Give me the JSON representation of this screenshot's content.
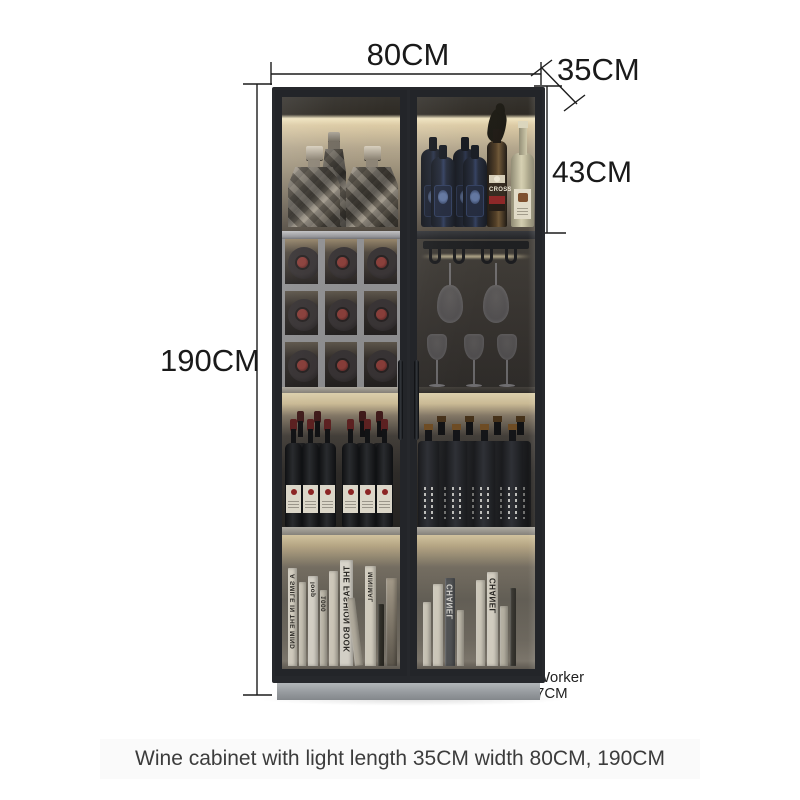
{
  "page": {
    "background": "#ffffff",
    "caption": "Wine cabinet with light length 35CM width 80CM, 190CM",
    "caption_color": "#3c3c3c",
    "caption_band_color": "#fafafa"
  },
  "dimensions": {
    "width": "80CM",
    "depth": "35CM",
    "top_section_height": "43CM",
    "height": "190CM",
    "base_note": "Worker",
    "base_height": "7CM",
    "line_color": "#1c1c1c"
  },
  "cabinet": {
    "frame_color": "#26282c",
    "base_color": "#a9adb0",
    "light_color": "#efe2bd",
    "accent_red": "#8c2424",
    "doors": 2,
    "top_shelf": {
      "decanters": 3,
      "blue_bottles": 4,
      "labeled_bottle": "CROSS",
      "white_wine_bottles": 1
    },
    "wine_rack": {
      "rows": 3,
      "columns": 3,
      "bottles": 9
    },
    "glass_rack": {
      "hanging_glasses": 2,
      "standing_glasses": 3
    },
    "bottle_rows": {
      "left_wine_bottles": 10,
      "right_square_bottles": 8
    },
    "book_labels_left": [
      "A SMILE IN THE MIND",
      "loop",
      "1000",
      "THE FASHION BOOK",
      "MINIMAL"
    ],
    "book_labels_right": [
      "CHANEL",
      "CHANEL"
    ]
  }
}
